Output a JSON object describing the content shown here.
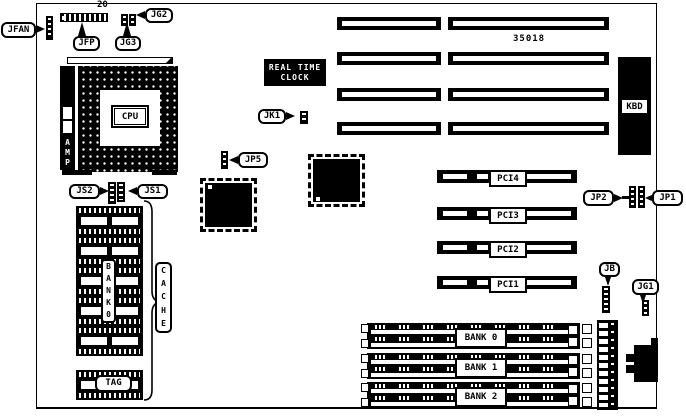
{
  "callouts": {
    "jfan": "JFAN",
    "jfp": "JFP",
    "jg2": "JG2",
    "jg3": "JG3",
    "jk1": "JK1",
    "jp5": "JP5",
    "js2": "JS2",
    "js1": "JS1",
    "jp2": "JP2",
    "jp1": "JP1",
    "jb": "JB",
    "jg1": "JG1"
  },
  "annotations": {
    "pin_count": "20",
    "part_number": "35018"
  },
  "components": {
    "cpu": "CPU",
    "amp_letters": [
      "A",
      "M",
      "P"
    ],
    "rtc_lines": [
      "REAL TIME",
      "CLOCK"
    ],
    "kbd": "KBD",
    "pci_slots": [
      "PCI4",
      "PCI3",
      "PCI2",
      "PCI1"
    ],
    "cache_letters": [
      "C",
      "A",
      "C",
      "H",
      "E"
    ],
    "bank0_letters": [
      "B",
      "A",
      "N",
      "K",
      "0"
    ],
    "tag": "TAG",
    "memory_banks": [
      "BANK 0",
      "BANK 1",
      "BANK 2"
    ]
  }
}
